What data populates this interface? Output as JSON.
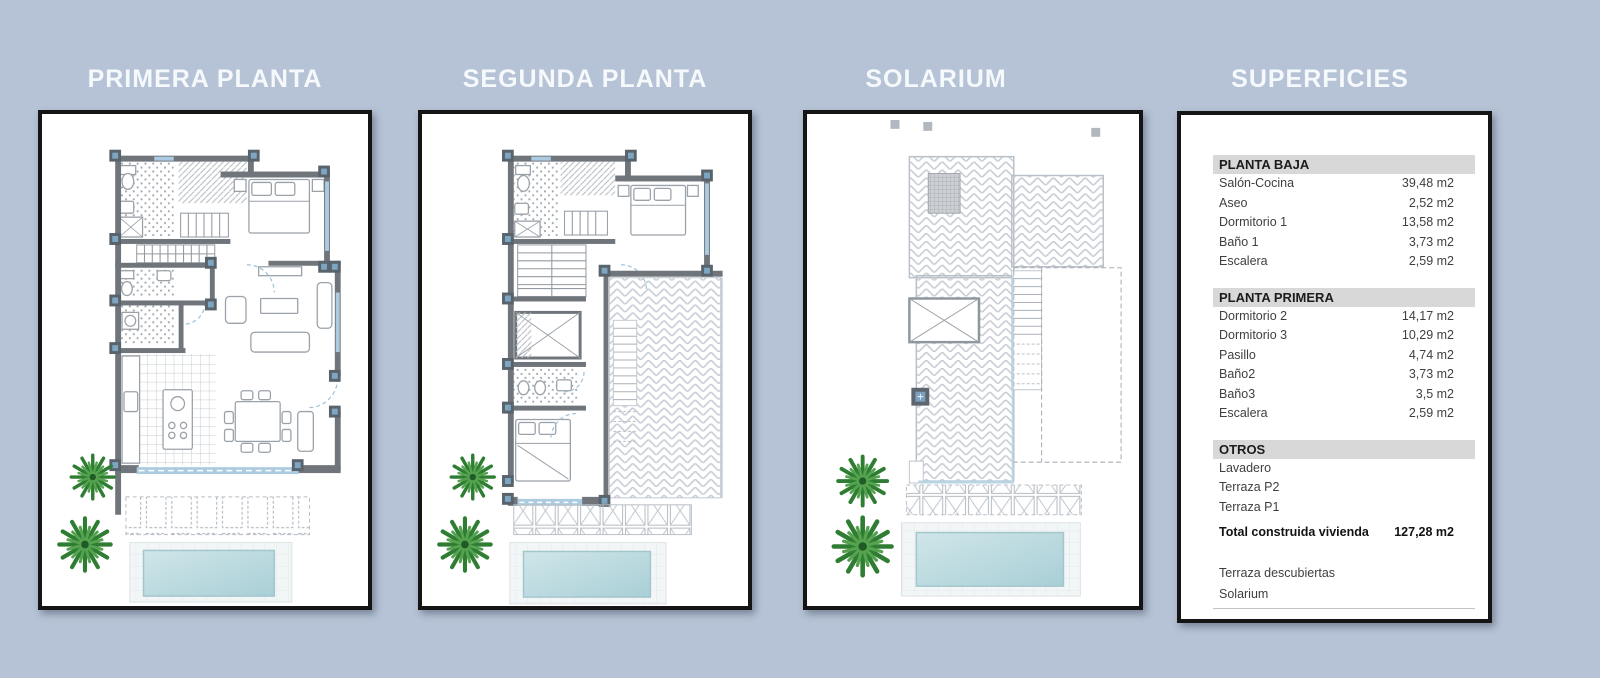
{
  "panels": [
    {
      "title": "PRIMERA PLANTA"
    },
    {
      "title": "SEGUNDA PLANTA"
    },
    {
      "title": "SOLARIUM"
    },
    {
      "title": "SUPERFICIES"
    }
  ],
  "superficies": {
    "sections": [
      {
        "header": "PLANTA BAJA",
        "rows": [
          {
            "label": "Salón-Cocina",
            "value": "39,48 m2"
          },
          {
            "label": "Aseo",
            "value": "2,52 m2"
          },
          {
            "label": "Dormitorio 1",
            "value": "13,58 m2"
          },
          {
            "label": "Baño 1",
            "value": "3,73 m2"
          },
          {
            "label": "Escalera",
            "value": "2,59 m2"
          }
        ]
      },
      {
        "header": "PLANTA PRIMERA",
        "rows": [
          {
            "label": "Dormitorio 2",
            "value": "14,17 m2"
          },
          {
            "label": "Dormitorio 3",
            "value": "10,29 m2"
          },
          {
            "label": "Pasillo",
            "value": "4,74 m2"
          },
          {
            "label": "Baño2",
            "value": "3,73 m2"
          },
          {
            "label": "Baño3",
            "value": "3,5 m2"
          },
          {
            "label": "Escalera",
            "value": "2,59 m2"
          }
        ]
      },
      {
        "header": "OTROS",
        "rows": [
          {
            "label": "Lavadero",
            "value": ""
          },
          {
            "label": "Terraza P2",
            "value": ""
          },
          {
            "label": "Terraza P1",
            "value": ""
          }
        ]
      }
    ],
    "total": {
      "label": "Total construida vivienda",
      "value": "127,28 m2"
    },
    "extras": [
      "Terraza descubiertas",
      "Solarium"
    ]
  },
  "colors": {
    "background": "#b6c2d5",
    "panel_border": "#151515",
    "section_header_bg": "#d8d8d8",
    "wall": "#6f757b",
    "pier_inner": "#7ea6c2",
    "window": "#abcbe0",
    "pool": "#b7d8dd",
    "tree": "#2e7d33"
  }
}
